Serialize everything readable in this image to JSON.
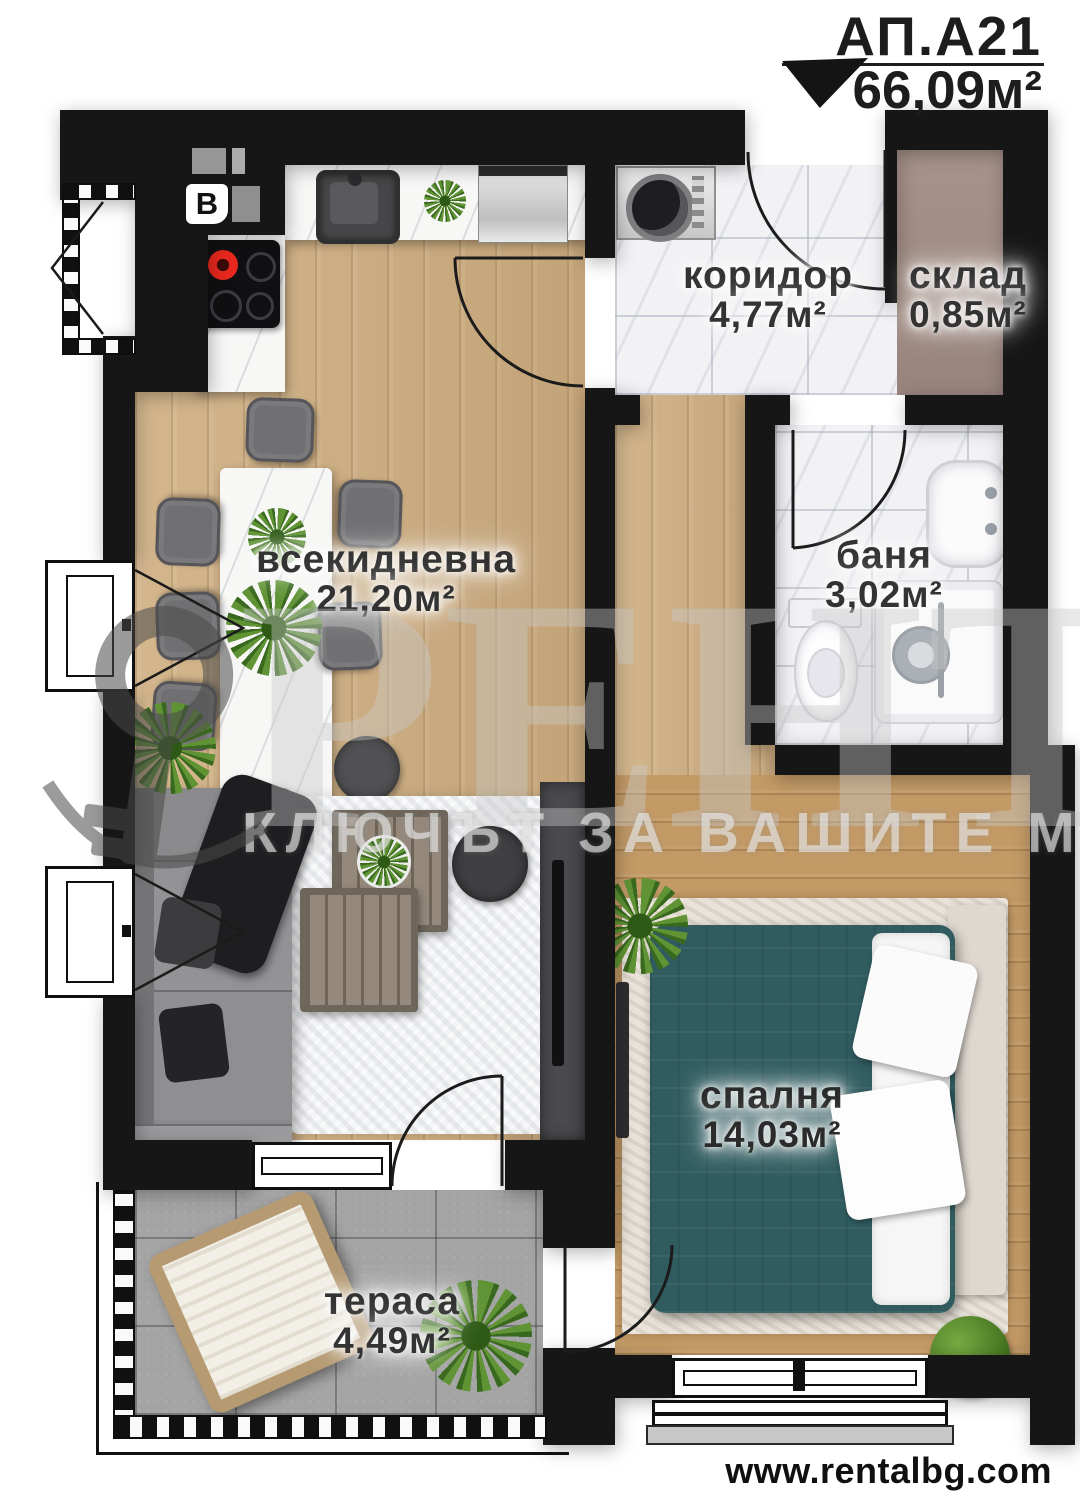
{
  "header": {
    "apartment_id": "АП.А21",
    "total_area": "66,09м²"
  },
  "rooms": [
    {
      "name": "коридор",
      "area": "4,77м²"
    },
    {
      "name": "склад",
      "area": "0,85м²"
    },
    {
      "name": "всекидневна",
      "area": "21,20м²"
    },
    {
      "name": "баня",
      "area": "3,02м²"
    },
    {
      "name": "спалня",
      "area": "14,03м²"
    },
    {
      "name": "тераса",
      "area": "4,49м²"
    }
  ],
  "markers": {
    "boiler_label": "B"
  },
  "watermark": {
    "brand": "РЕНТАЛ",
    "slogan": "КЛЮЧЪТ ЗА ВАШИТЕ МЕЧТИ"
  },
  "footer": {
    "website": "www.rentalbg.com"
  },
  "colors": {
    "wall": "#161616",
    "wood_living": "#cfae80",
    "wood_bedroom": "#c39a66",
    "bed_teal": "#305c60",
    "terrace_tile": "#a4a4a4",
    "storage_floor": "#a8938a",
    "burner_red": "#e8281e"
  }
}
